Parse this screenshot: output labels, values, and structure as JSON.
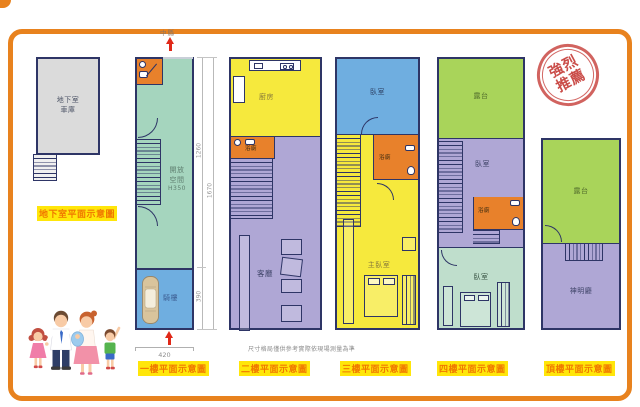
{
  "north_label": "中縣",
  "disclaimer": "尺寸格局僅供參考實際依現場測量為準",
  "stamp": {
    "line1": "強烈",
    "line2": "推薦"
  },
  "plans": {
    "basement": {
      "title": "地下室平面示意圖",
      "garage": [
        "地下室",
        "車庫"
      ]
    },
    "f1": {
      "title": "一樓平面示意圖",
      "open": [
        "開放",
        "空間"
      ],
      "height_note": "H350",
      "arcade": "騎樓",
      "dims": {
        "inner_top": "1260",
        "outer": "1670",
        "inner_bottom": "390",
        "width": "420"
      }
    },
    "f2": {
      "title": "二樓平面示意圖",
      "kitchen": "廚房",
      "bath": "浴廁",
      "living": "客廳"
    },
    "f3": {
      "title": "三樓平面示意圖",
      "bedroom": "臥室",
      "bath": "浴廁",
      "master": "主臥室"
    },
    "f4": {
      "title": "四樓平面示意圖",
      "terrace": "露台",
      "bedroom_mid": "臥室",
      "bath": "浴廁",
      "bedroom_low": "臥室"
    },
    "roof": {
      "title": "頂樓平面示意圖",
      "terrace": "露台",
      "shrine": "神明廳"
    }
  },
  "palette": {
    "frame_orange": "#E8821E",
    "wall_navy": "#2E3566",
    "green_f1": "#A5D5BE",
    "blue_room": "#6FAEE0",
    "yellow_room": "#F6E93D",
    "purple_room": "#AFA7D5",
    "orange_bath": "#E8812B",
    "terrace_green": "#A9D45A",
    "lightgreen_bed": "#BFDECC",
    "basement_gray": "#DBDBDB",
    "title_text": "#F07800",
    "title_bg": "#FFE60A",
    "stamp_red": "#C84440",
    "arrow_red": "#E02818"
  }
}
